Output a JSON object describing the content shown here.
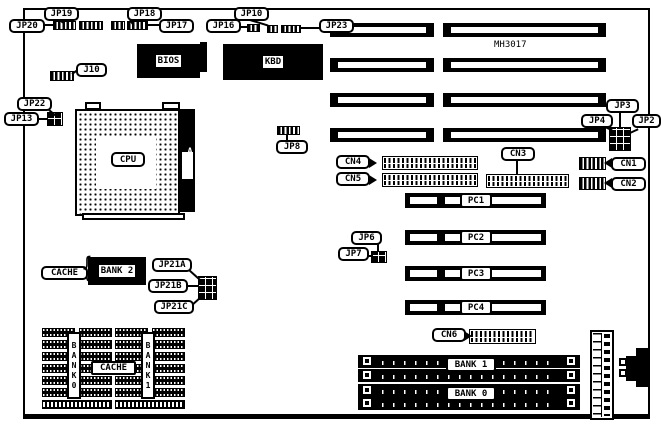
{
  "board": {
    "part_number": "MH3017"
  },
  "callouts": {
    "jp19": "JP19",
    "jp20": "JP20",
    "jp18": "JP18",
    "jp17": "JP17",
    "jp10": "JP10",
    "jp16": "JP16",
    "jp23": "JP23",
    "j10": "J10",
    "jp22": "JP22",
    "jp13": "JP13",
    "jp8": "JP8",
    "jp3": "JP3",
    "jp4": "JP4",
    "jp2": "JP2",
    "cn1": "CN1",
    "cn2": "CN2",
    "cn3": "CN3",
    "cn4": "CN4",
    "cn5": "CN5",
    "cn6": "CN6",
    "jp6": "JP6",
    "jp7": "JP7",
    "jp21a": "JP21A",
    "jp21b": "JP21B",
    "jp21c": "JP21C",
    "cache": "CACHE"
  },
  "components": {
    "bios": "BIOS",
    "kbd": "KBD",
    "cpu": "CPU",
    "amp": "AMP",
    "bank2": "BANK 2",
    "cache_sram": "CACHE",
    "bank0_vertical": "BANK0",
    "bank1_vertical": "BANK1"
  },
  "slots": {
    "pci": [
      "PC1",
      "PC2",
      "PC3",
      "PC4"
    ],
    "simm_banks": [
      "BANK 1",
      "BANK 0"
    ]
  },
  "decor": {
    "brace": "{"
  }
}
